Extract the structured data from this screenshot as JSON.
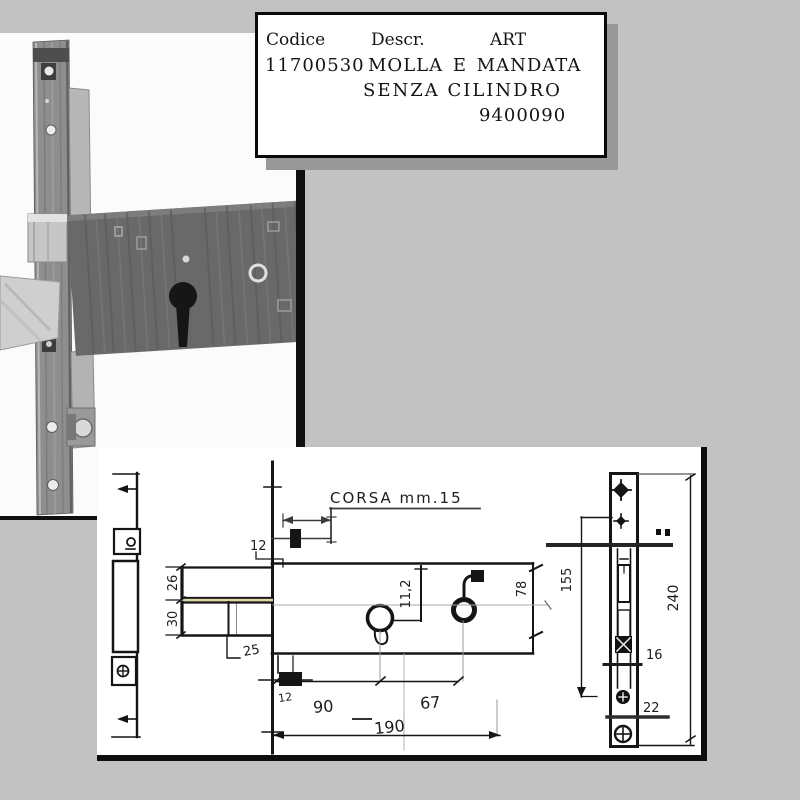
{
  "label_box": {
    "col_headers": [
      "Codice",
      "Descr.",
      "ART"
    ],
    "code": "11700530",
    "description_line1": "MOLLA E MANDATA",
    "description_line2": "SENZA CILINDRO",
    "art_number": "9400090"
  },
  "drawing": {
    "stroke_note": "CORSA  mm.15",
    "dims": {
      "front_offset_top": "12",
      "latch_height": "26",
      "deadbolt_height": "30",
      "deadbolt_throw": "25",
      "cylinder_offset": "11,2",
      "body_height": "78",
      "plate_mid_span": "155",
      "plate_height": "240",
      "hole_span": "16",
      "bottom_gap": "22",
      "step_bottom": "12",
      "backset": "90",
      "cam_distance": "67",
      "body_length": "190"
    }
  },
  "colors": {
    "background": "#c2c2c2",
    "paper": "#ffffff",
    "ink": "#111111",
    "shadow": "#989898",
    "highlight_strip": "#ded7a8"
  }
}
